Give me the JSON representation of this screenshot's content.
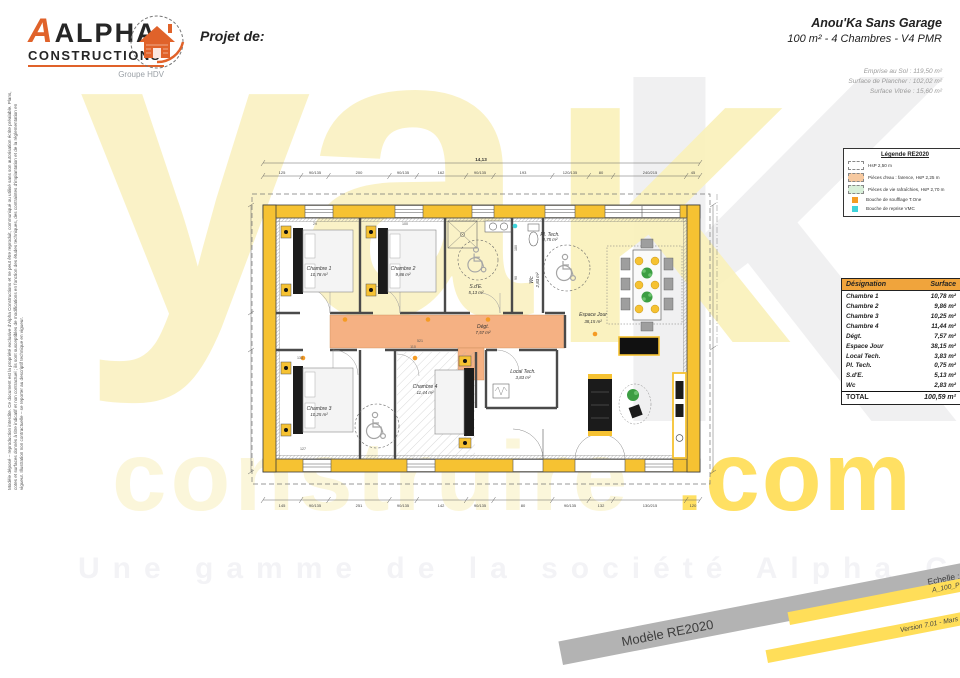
{
  "header": {
    "logo": {
      "brand_top": "ALPHA",
      "brand_bottom": "CONSTRUCTIONS",
      "group": "Groupe HDV"
    },
    "project_label": "Projet de:",
    "project_title": "Anou'Ka Sans Garage",
    "project_subtitle": "100 m² - 4 Chambres - V4 PMR",
    "metric_1": "Emprise au Sol : 119,50 m²",
    "metric_2": "Surface de Plancher : 102,02 m²",
    "metric_3": "Surface Vitrée : 15,60 m²"
  },
  "legend": {
    "title": "Légende RE2020",
    "items": [
      {
        "label": "HsP 2,50 m"
      },
      {
        "label": "Pièces d'eau : faïence, HsP 2,25 m"
      },
      {
        "label": "Pièces de vie rafraîchies, HsP 2,70 m"
      },
      {
        "label": "Bouche de soufflage T.One"
      },
      {
        "label": "Bouche de reprise VMC"
      }
    ]
  },
  "surface_table": {
    "headers": [
      "Désignation",
      "Surface"
    ],
    "rows": [
      [
        "Chambre 1",
        "10,78 m²"
      ],
      [
        "Chambre 2",
        "9,86 m²"
      ],
      [
        "Chambre 3",
        "10,25 m²"
      ],
      [
        "Chambre 4",
        "11,44 m²"
      ],
      [
        "Dégt.",
        "7,57 m²"
      ],
      [
        "Espace Jour",
        "38,15 m²"
      ],
      [
        "Local Tech.",
        "3,83 m²"
      ],
      [
        "Pl. Tech.",
        "0,75 m²"
      ],
      [
        "S.d'E.",
        "5,13 m²"
      ],
      [
        "Wc",
        "2,83 m²"
      ]
    ],
    "total": {
      "label": "TOTAL",
      "value": "100,59 m²"
    }
  },
  "plan": {
    "rooms": [
      {
        "name": "Chambre 1",
        "area": "10,78 m²"
      },
      {
        "name": "Chambre 2",
        "area": "9,86 m²"
      },
      {
        "name": "Chambre 3",
        "area": "10,25 m²"
      },
      {
        "name": "Chambre 4",
        "area": "11,44 m²"
      },
      {
        "name": "Dégt.",
        "area": "7,57 m²"
      },
      {
        "name": "Espace Jour",
        "area": "38,15 m²"
      },
      {
        "name": "Local Tech.",
        "area": "3,83 m²"
      },
      {
        "name": "Pl. Tech.",
        "area": "0,75 m²"
      },
      {
        "name": "S.d'E.",
        "area": "5,13 m²"
      },
      {
        "name": "Wc",
        "area": "2,83 m²"
      }
    ],
    "overall_top": "14,13",
    "top_dims": [
      "125",
      "90/135",
      "200",
      "90/135",
      "162",
      "90/135",
      "193",
      "120/135",
      "80",
      "240/215",
      "45"
    ],
    "bottom_dims": [
      "145",
      "90/135",
      "251",
      "90/135",
      "142",
      "90/135",
      "80",
      "90/135",
      "132",
      "130/215",
      "120"
    ],
    "inner_dims": [
      "180",
      "90",
      "100",
      "29",
      "133",
      "110",
      "521",
      "127"
    ]
  },
  "watermark": {
    "big": "ya",
    "big_k": "K",
    "mid": "construire",
    "com": ".com",
    "tagline": "Une gamme de la société Alpha Constructions"
  },
  "ribbons": {
    "model": "Modèle RE2020",
    "scale": "Echelle : 1/75è",
    "ref": "A_100_P2_V4",
    "version": "Version 7.01 - Mars 2023"
  },
  "legal": "Modèle déposé – reproduction interdite. Ce document est la propriété exclusive d'Alpha Constructions et ne peut être reproduit, communiqué ou utilisé sans son autorisation écrite préalable. Plans, cotes et surfaces donnés à titre indicatif et non contractuel ; ils sont susceptibles de modifications en fonction des études techniques, des contraintes d'implantation et de la réglementation en vigueur. Illustration non contractuelle – se reporter au descriptif technique en vigueur."
}
